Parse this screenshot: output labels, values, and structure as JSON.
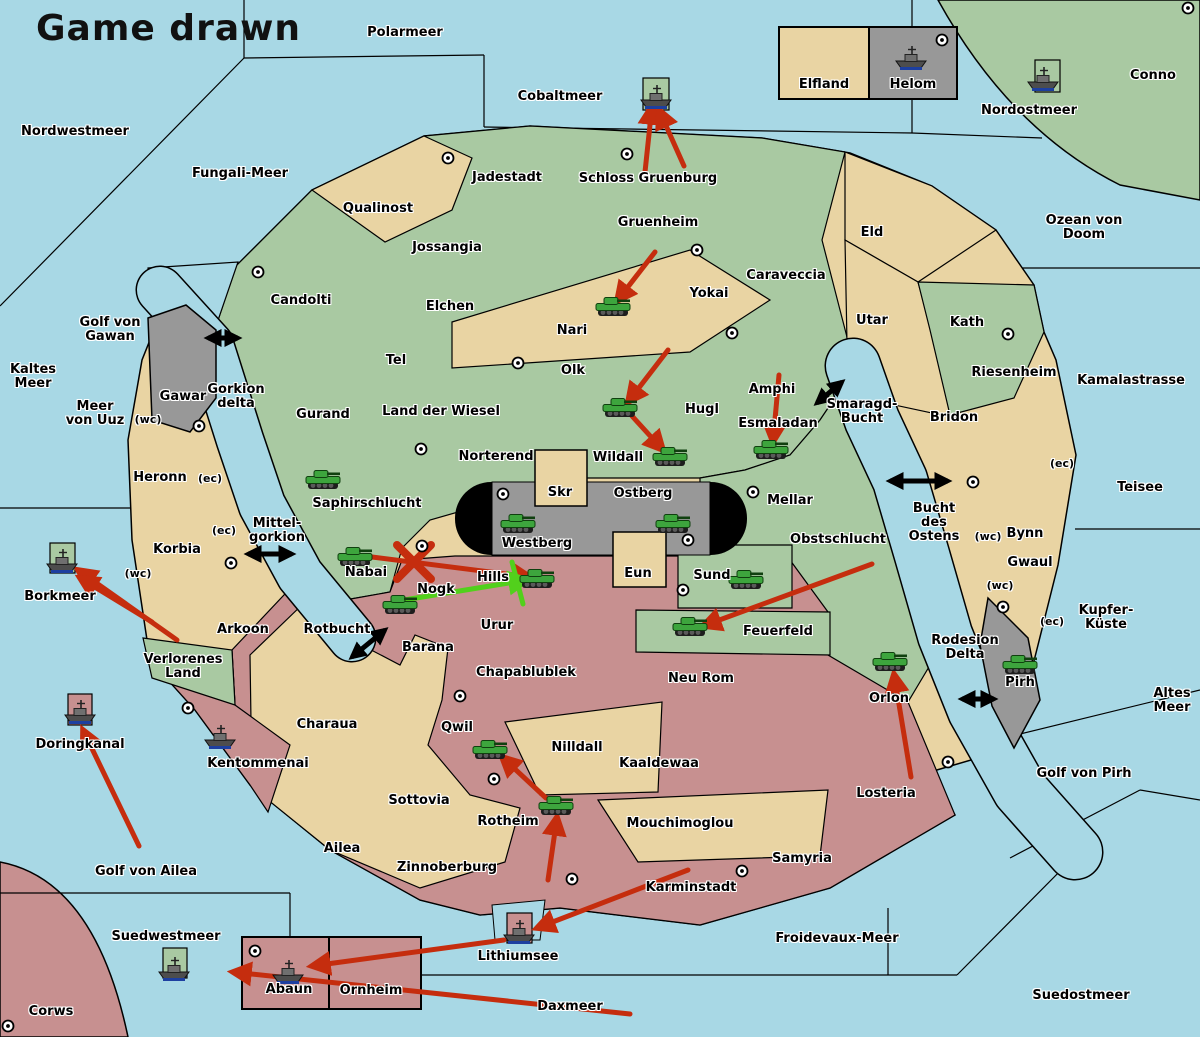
{
  "title": "Game drawn",
  "colors": {
    "sea": "#a8d8e5",
    "land_neutral_tan": "#e9d4a3",
    "land_green": "#a9c9a2",
    "land_red": "#c79090",
    "land_gray": "#989898",
    "capsule_black": "#000000",
    "attack_arrow_red": "#c52d0e",
    "support_arrow_green": "#52d01c",
    "strait_arrow_black": "#000000",
    "unit_green": "#3da53d"
  },
  "map": {
    "labels": [
      {
        "t": "Polarmeer",
        "x": 405,
        "y": 33
      },
      {
        "t": "Nordwestmeer",
        "x": 75,
        "y": 132
      },
      {
        "t": "Fungali-Meer",
        "x": 240,
        "y": 174
      },
      {
        "t": "Cobaltmeer",
        "x": 560,
        "y": 97
      },
      {
        "t": "Nordostmeer",
        "x": 1029,
        "y": 111
      },
      {
        "t": "Conno",
        "x": 1153,
        "y": 76
      },
      {
        "t": "Ozean von Doom",
        "x": 1084,
        "y": 228
      },
      {
        "t": "Elfland",
        "x": 824,
        "y": 85
      },
      {
        "t": "Helom",
        "x": 913,
        "y": 85
      },
      {
        "t": "Jadestadt",
        "x": 507,
        "y": 178
      },
      {
        "t": "Schloss Gruenburg",
        "x": 648,
        "y": 179
      },
      {
        "t": "Qualinost",
        "x": 378,
        "y": 209
      },
      {
        "t": "Jossangia",
        "x": 447,
        "y": 248
      },
      {
        "t": "Candolti",
        "x": 301,
        "y": 301
      },
      {
        "t": "Elchen",
        "x": 450,
        "y": 307
      },
      {
        "t": "Gruenheim",
        "x": 658,
        "y": 223
      },
      {
        "t": "Caraveccia",
        "x": 786,
        "y": 276
      },
      {
        "t": "Yokai",
        "x": 709,
        "y": 294
      },
      {
        "t": "Eld",
        "x": 872,
        "y": 233
      },
      {
        "t": "Utar",
        "x": 872,
        "y": 321
      },
      {
        "t": "Kath",
        "x": 967,
        "y": 323
      },
      {
        "t": "Riesenheim",
        "x": 1014,
        "y": 373
      },
      {
        "t": "Kamalastrasse",
        "x": 1131,
        "y": 381
      },
      {
        "t": "Teisee",
        "x": 1140,
        "y": 488
      },
      {
        "t": "Golf von\nGawan",
        "x": 110,
        "y": 330
      },
      {
        "t": "Kaltes\nMeer",
        "x": 33,
        "y": 377
      },
      {
        "t": "Meer\nvon Uuz",
        "x": 95,
        "y": 414
      },
      {
        "t": "Gawar",
        "x": 183,
        "y": 397
      },
      {
        "t": "Gorkion\ndelta",
        "x": 236,
        "y": 397
      },
      {
        "t": "(wc)",
        "x": 148,
        "y": 420,
        "c": "s"
      },
      {
        "t": "Nari",
        "x": 572,
        "y": 331
      },
      {
        "t": "Olk",
        "x": 573,
        "y": 371
      },
      {
        "t": "Tel",
        "x": 396,
        "y": 361
      },
      {
        "t": "Gurand",
        "x": 323,
        "y": 415
      },
      {
        "t": "Land der Wiesel",
        "x": 441,
        "y": 412
      },
      {
        "t": "Norterend",
        "x": 496,
        "y": 457
      },
      {
        "t": "Hugl",
        "x": 702,
        "y": 410
      },
      {
        "t": "Amphi",
        "x": 772,
        "y": 390
      },
      {
        "t": "Esmaladan",
        "x": 778,
        "y": 424
      },
      {
        "t": "Wildall",
        "x": 618,
        "y": 458
      },
      {
        "t": "Smaragd-\nBucht",
        "x": 862,
        "y": 412
      },
      {
        "t": "Bridon",
        "x": 954,
        "y": 418
      },
      {
        "t": "Saphirschlucht",
        "x": 367,
        "y": 504
      },
      {
        "t": "Skr",
        "x": 560,
        "y": 493
      },
      {
        "t": "Ostberg",
        "x": 643,
        "y": 494
      },
      {
        "t": "Westberg",
        "x": 537,
        "y": 544
      },
      {
        "t": "Mellar",
        "x": 790,
        "y": 501
      },
      {
        "t": "Obstschlucht",
        "x": 838,
        "y": 540
      },
      {
        "t": "Heronn",
        "x": 160,
        "y": 478
      },
      {
        "t": "(ec)",
        "x": 210,
        "y": 479,
        "c": "s"
      },
      {
        "t": "Mittel-\ngorkion",
        "x": 277,
        "y": 531
      },
      {
        "t": "(ec)",
        "x": 224,
        "y": 531,
        "c": "s"
      },
      {
        "t": "Korbia",
        "x": 177,
        "y": 550
      },
      {
        "t": "(wc)",
        "x": 138,
        "y": 574,
        "c": "s"
      },
      {
        "t": "Borkmeer",
        "x": 60,
        "y": 597
      },
      {
        "t": "Bucht\ndes\nOstens",
        "x": 934,
        "y": 523
      },
      {
        "t": "(ec)",
        "x": 1062,
        "y": 464,
        "c": "s"
      },
      {
        "t": "(wc)",
        "x": 988,
        "y": 537,
        "c": "s"
      },
      {
        "t": "Bynn",
        "x": 1025,
        "y": 534
      },
      {
        "t": "Gwaul",
        "x": 1030,
        "y": 563
      },
      {
        "t": "(wc)",
        "x": 1000,
        "y": 586,
        "c": "s"
      },
      {
        "t": "(ec)",
        "x": 1052,
        "y": 622,
        "c": "s"
      },
      {
        "t": "Kupfer-\nKüste",
        "x": 1106,
        "y": 618
      },
      {
        "t": "Nabai",
        "x": 366,
        "y": 573
      },
      {
        "t": "Nogk",
        "x": 436,
        "y": 590
      },
      {
        "t": "Hills",
        "x": 493,
        "y": 578
      },
      {
        "t": "Eun",
        "x": 638,
        "y": 574
      },
      {
        "t": "Sund",
        "x": 712,
        "y": 576
      },
      {
        "t": "Mellar2",
        "x": -100,
        "y": -100
      },
      {
        "t": "Rotbucht",
        "x": 337,
        "y": 630
      },
      {
        "t": "Barana",
        "x": 428,
        "y": 648
      },
      {
        "t": "Urur",
        "x": 497,
        "y": 626
      },
      {
        "t": "Arkoon",
        "x": 243,
        "y": 630
      },
      {
        "t": "Verlorenes\nLand",
        "x": 183,
        "y": 667
      },
      {
        "t": "Feuerfeld",
        "x": 778,
        "y": 632
      },
      {
        "t": "Neu Rom",
        "x": 701,
        "y": 679
      },
      {
        "t": "Chapablublek",
        "x": 526,
        "y": 673
      },
      {
        "t": "Rodesion\nDelta",
        "x": 965,
        "y": 648
      },
      {
        "t": "Pirh",
        "x": 1020,
        "y": 683
      },
      {
        "t": "Orlon",
        "x": 889,
        "y": 699
      },
      {
        "t": "Altes\nMeer",
        "x": 1172,
        "y": 701
      },
      {
        "t": "Golf von Pirh",
        "x": 1084,
        "y": 774
      },
      {
        "t": "Losteria",
        "x": 886,
        "y": 794
      },
      {
        "t": "Doringkanal",
        "x": 80,
        "y": 745
      },
      {
        "t": "Kentommenai",
        "x": 258,
        "y": 764
      },
      {
        "t": "Charaua",
        "x": 327,
        "y": 725
      },
      {
        "t": "Qwil",
        "x": 457,
        "y": 728
      },
      {
        "t": "Nilldall",
        "x": 577,
        "y": 748
      },
      {
        "t": "Kaaldewaa",
        "x": 659,
        "y": 764
      },
      {
        "t": "Sottovia",
        "x": 419,
        "y": 801
      },
      {
        "t": "Rotheim",
        "x": 508,
        "y": 822
      },
      {
        "t": "Mouchimoglou",
        "x": 680,
        "y": 824
      },
      {
        "t": "Golf von Pirh2",
        "x": -100,
        "y": -100
      },
      {
        "t": "Ailea",
        "x": 342,
        "y": 849
      },
      {
        "t": "Zinnoberburg",
        "x": 447,
        "y": 868
      },
      {
        "t": "Karminstadt",
        "x": 691,
        "y": 888
      },
      {
        "t": "Samyria",
        "x": 802,
        "y": 859
      },
      {
        "t": "Golf von Ailea",
        "x": 146,
        "y": 872
      },
      {
        "t": "Suedwestmeer",
        "x": 166,
        "y": 937
      },
      {
        "t": "Lithiumsee",
        "x": 518,
        "y": 957
      },
      {
        "t": "Froidevaux-Meer",
        "x": 837,
        "y": 939
      },
      {
        "t": "Corws",
        "x": 51,
        "y": 1012
      },
      {
        "t": "Abaun",
        "x": 289,
        "y": 990
      },
      {
        "t": "Ornheim",
        "x": 371,
        "y": 991
      },
      {
        "t": "Daxmeer",
        "x": 570,
        "y": 1007
      },
      {
        "t": "Suedostmeer",
        "x": 1081,
        "y": 996
      }
    ],
    "units": [
      {
        "k": "army",
        "x": 613,
        "y": 307
      },
      {
        "k": "army",
        "x": 620,
        "y": 408
      },
      {
        "k": "army",
        "x": 670,
        "y": 457
      },
      {
        "k": "army",
        "x": 771,
        "y": 450
      },
      {
        "k": "army",
        "x": 323,
        "y": 480
      },
      {
        "k": "army",
        "x": 518,
        "y": 524
      },
      {
        "k": "army",
        "x": 673,
        "y": 524
      },
      {
        "k": "army",
        "x": 355,
        "y": 557
      },
      {
        "k": "army",
        "x": 400,
        "y": 605
      },
      {
        "k": "army",
        "x": 537,
        "y": 579
      },
      {
        "k": "army",
        "x": 746,
        "y": 580
      },
      {
        "k": "army",
        "x": 690,
        "y": 627
      },
      {
        "k": "army",
        "x": 890,
        "y": 662
      },
      {
        "k": "army",
        "x": 1020,
        "y": 665
      },
      {
        "k": "army",
        "x": 556,
        "y": 806
      },
      {
        "k": "army",
        "x": 490,
        "y": 750
      },
      {
        "k": "fleet",
        "x": 656,
        "y": 97
      },
      {
        "k": "fleet",
        "x": 911,
        "y": 58
      },
      {
        "k": "fleet",
        "x": 1043,
        "y": 79
      },
      {
        "k": "fleet",
        "x": 62,
        "y": 561
      },
      {
        "k": "fleet",
        "x": 80,
        "y": 712
      },
      {
        "k": "fleet",
        "x": 220,
        "y": 737
      },
      {
        "k": "fleet",
        "x": 519,
        "y": 932
      },
      {
        "k": "fleet",
        "x": 174,
        "y": 969
      },
      {
        "k": "fleet",
        "x": 288,
        "y": 972
      }
    ],
    "supply_centers": [
      [
        448,
        158
      ],
      [
        627,
        154
      ],
      [
        942,
        40
      ],
      [
        1188,
        8
      ],
      [
        258,
        272
      ],
      [
        697,
        250
      ],
      [
        732,
        333
      ],
      [
        518,
        363
      ],
      [
        1008,
        334
      ],
      [
        199,
        426
      ],
      [
        421,
        449
      ],
      [
        503,
        494
      ],
      [
        753,
        492
      ],
      [
        973,
        482
      ],
      [
        688,
        540
      ],
      [
        422,
        546
      ],
      [
        683,
        590
      ],
      [
        231,
        563
      ],
      [
        188,
        708
      ],
      [
        1003,
        607
      ],
      [
        948,
        762
      ],
      [
        460,
        696
      ],
      [
        494,
        779
      ],
      [
        572,
        879
      ],
      [
        742,
        871
      ],
      [
        255,
        951
      ],
      [
        8,
        1026
      ]
    ],
    "red_arrows": [
      [
        645,
        172,
        652,
        106
      ],
      [
        684,
        166,
        659,
        110
      ],
      [
        655,
        252,
        617,
        301
      ],
      [
        668,
        350,
        628,
        402
      ],
      [
        632,
        416,
        663,
        450
      ],
      [
        372,
        557,
        530,
        577
      ],
      [
        779,
        375,
        773,
        442
      ],
      [
        872,
        564,
        703,
        626
      ],
      [
        911,
        777,
        894,
        674
      ],
      [
        548,
        880,
        557,
        817
      ],
      [
        546,
        798,
        502,
        757
      ],
      [
        688,
        870,
        537,
        928
      ],
      [
        504,
        940,
        312,
        966
      ],
      [
        630,
        1014,
        233,
        972
      ],
      [
        177,
        640,
        78,
        570
      ],
      [
        152,
        622,
        80,
        578
      ],
      [
        139,
        846,
        83,
        730
      ]
    ],
    "red_x": [
      414,
      562
    ],
    "green_arrows": [
      [
        404,
        600,
        527,
        580
      ]
    ],
    "green_marks": [
      [
        512,
        562,
        523,
        604
      ]
    ],
    "straits": [
      [
        208,
        338,
        238,
        338
      ],
      [
        248,
        554,
        292,
        554
      ],
      [
        817,
        403,
        842,
        382
      ],
      [
        890,
        481,
        948,
        481
      ],
      [
        352,
        657,
        385,
        630
      ],
      [
        962,
        699,
        994,
        699
      ]
    ]
  }
}
